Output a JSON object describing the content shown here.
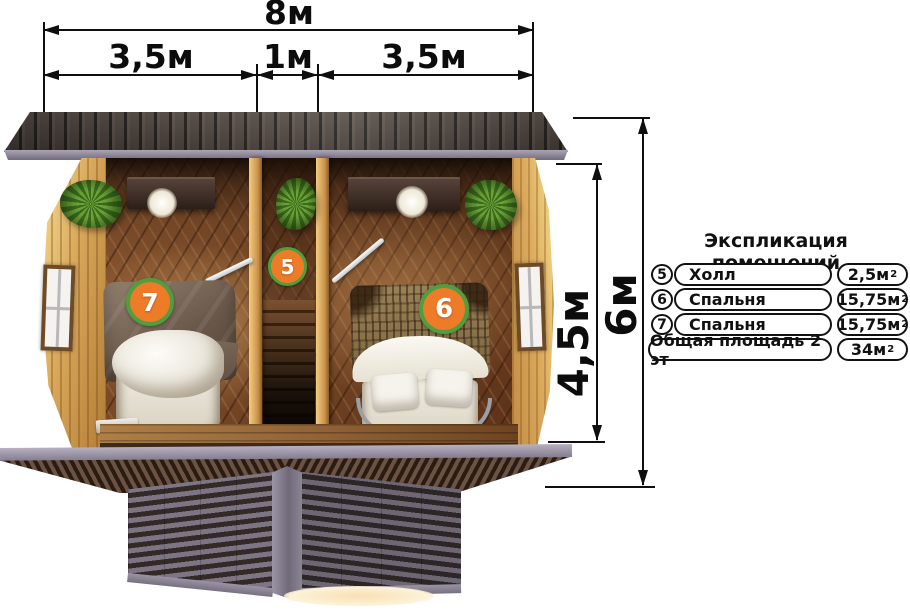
{
  "dims": {
    "total": "8м",
    "seg_left": "3,5м",
    "seg_mid": "1м",
    "seg_right": "3,5м",
    "height_inner": "4,5м",
    "height_outer": "6м"
  },
  "legend": {
    "title": "Экспликация помещений",
    "rows": [
      {
        "num": "5",
        "name": "Холл",
        "area": "2,5м",
        "sup": "2"
      },
      {
        "num": "6",
        "name": "Спальня",
        "area": "15,75м",
        "sup": "2"
      },
      {
        "num": "7",
        "name": "Спальня",
        "area": "15,75м",
        "sup": "2"
      }
    ],
    "total": {
      "label": "Общая площадь 2 эт",
      "area": "34м",
      "sup": "2"
    }
  },
  "plan": {
    "badges": [
      {
        "number": "5"
      },
      {
        "number": "6"
      },
      {
        "number": "7"
      }
    ]
  },
  "colors": {
    "badge_fill": "#ee7b28",
    "badge_ring": "#4f9e3f",
    "dimension_line": "#0f0f0f",
    "roof": "#4a403b",
    "exterior_wood": "#d8a75a",
    "floor_wood": "#7a4c2c",
    "trim_gray": "#8d8798"
  }
}
